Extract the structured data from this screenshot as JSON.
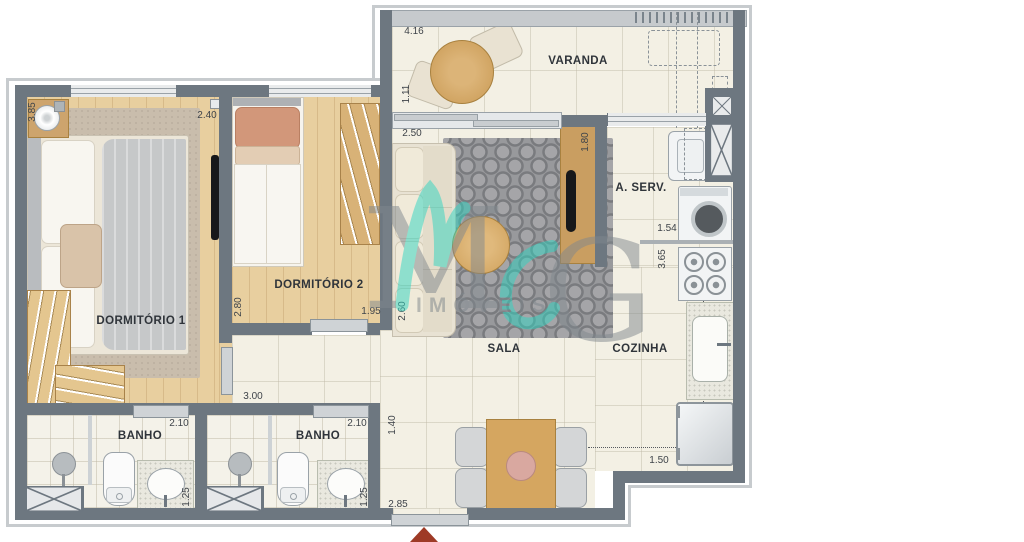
{
  "rooms": {
    "varanda": "VARANDA",
    "dorm1": "DORMITÓRIO 1",
    "dorm2": "DORMITÓRIO 2",
    "sala": "SALA",
    "cozinha": "COZINHA",
    "aserv": "A. SERV.",
    "banho1": "BANHO",
    "banho2": "BANHO"
  },
  "dims": {
    "dorm1_depth": "3.85",
    "dorm1_width": "2.40",
    "dorm2_depth": "2.80",
    "dorm2_width": "1.95",
    "varanda_width": "4.16",
    "varanda_depth": "1.11",
    "sala_width": "2.50",
    "sala_depth": "2.60",
    "tv_panel_width": "1.80",
    "aserv_width": "1.54",
    "cozinha_depth": "3.65",
    "cozinha_width": "1.50",
    "dining_depth": "1.40",
    "dining_width": "2.85",
    "hall_width": "3.00",
    "banho1_width": "2.10",
    "banho1_depth": "1.25",
    "banho2_width": "2.10",
    "banho2_depth": "1.25"
  },
  "watermark": {
    "monogram_m": "M",
    "monogram_g": "G",
    "brand": "IMÓVEIS"
  },
  "colors": {
    "wall": "#6d7780",
    "wood": "#e8cf9f",
    "tile": "#f3f0e4",
    "teal": "#2fd6c2",
    "arrow": "#9e3a26"
  }
}
